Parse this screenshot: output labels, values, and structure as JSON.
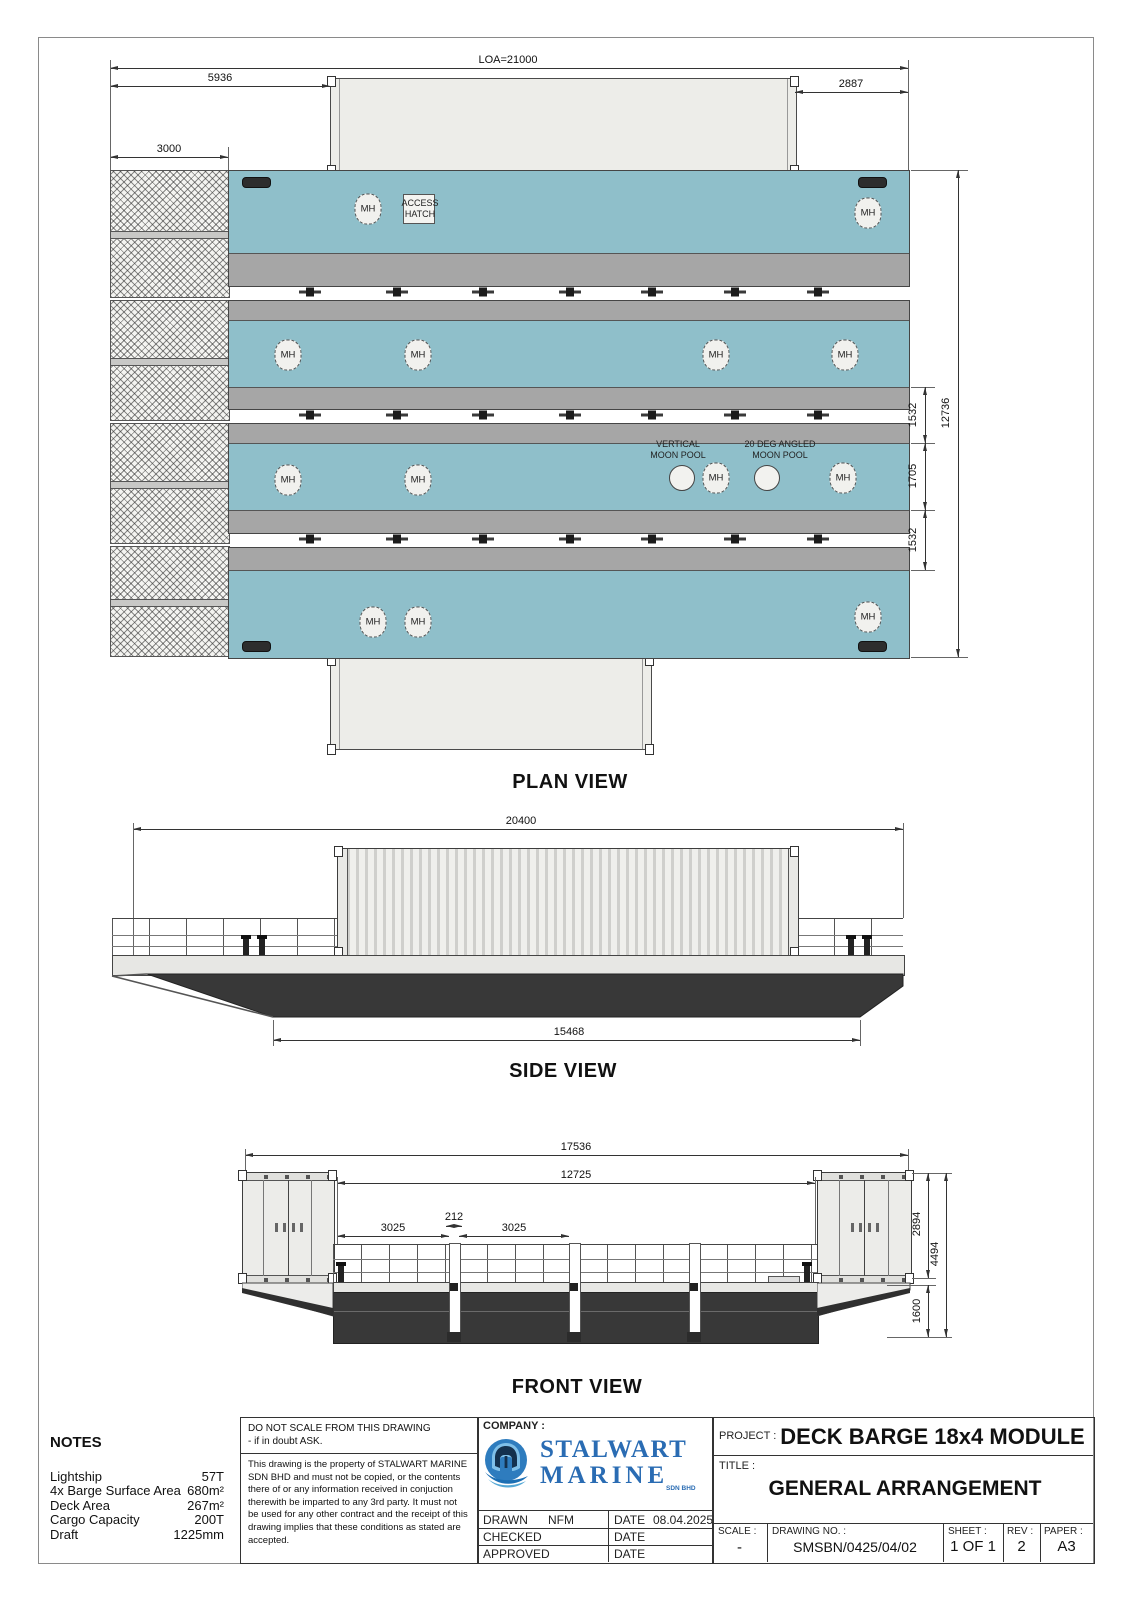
{
  "plan": {
    "dims": {
      "loa": "LOA=21000",
      "fore_deck": "5936",
      "aft_deck": "2887",
      "ramp_length": "3000",
      "spacing_top": "1532",
      "moonpool_bay": "1705",
      "spacing_bottom": "1532",
      "breadth_overall": "12736"
    },
    "labels": {
      "mh": "MH",
      "access_hatch": "ACCESS HATCH",
      "vertical_moon_pool": "VERTICAL MOON POOL",
      "angled_moon_pool": "20 DEG ANGLED MOON POOL"
    },
    "caption": "PLAN VIEW"
  },
  "side": {
    "dims": {
      "length_overall": "20400",
      "bottom_length": "15468"
    },
    "caption": "SIDE VIEW"
  },
  "front": {
    "dims": {
      "width_overall": "17536",
      "deck_width": "12725",
      "bay_left": "3025",
      "post_width": "212",
      "bay_right": "3025",
      "container_height": "2894",
      "overall_height": "4494",
      "hull_depth": "1600"
    },
    "caption": "FRONT VIEW"
  },
  "notes": {
    "title": "NOTES",
    "rows": [
      {
        "label": "Lightship",
        "value": "57T"
      },
      {
        "label": "4x Barge Surface Area",
        "value": "680m²"
      },
      {
        "label": "Deck Area",
        "value": "267m²"
      },
      {
        "label": "Cargo Capacity",
        "value": "200T"
      },
      {
        "label": "Draft",
        "value": "1225mm"
      }
    ]
  },
  "disclaimer": {
    "warning_line1": "DO NOT SCALE FROM THIS DRAWING",
    "warning_line2": "- if in doubt ASK.",
    "body": "This drawing is the property of STALWART MARINE SDN BHD and must not be copied, or the contents there of or any information received in conjuction therewith be imparted to any 3rd party. It must not be used for any other contract and the receipt of this drawing implies that these conditions as stated are accepted."
  },
  "company": {
    "label": "COMPANY :",
    "name_line1": "STALWART",
    "name_line2": "MARINE",
    "suffix": "SDN BHD",
    "drawn_label": "DRAWN",
    "drawn_value": "NFM",
    "date_label": "DATE",
    "drawn_date": "08.04.2025",
    "checked_label": "CHECKED",
    "approved_label": "APPROVED"
  },
  "title_block": {
    "project_label": "PROJECT :",
    "project_value": "DECK BARGE 18x4 MODULE",
    "title_label": "TITLE :",
    "title_value": "GENERAL ARRANGEMENT",
    "scale_label": "SCALE :",
    "scale_value": "-",
    "drawing_no_label": "DRAWING NO. :",
    "drawing_no_value": "SMSBN/0425/04/02",
    "sheet_label": "SHEET :",
    "sheet_value": "1 OF 1",
    "rev_label": "REV :",
    "rev_value": "2",
    "paper_label": "PAPER :",
    "paper_value": "A3"
  },
  "colors": {
    "deck_teal": "#8FBFCA",
    "side_strip": "#A6A6A6",
    "hull_dark": "#383838",
    "logo_blue": "#2A6CB3"
  }
}
